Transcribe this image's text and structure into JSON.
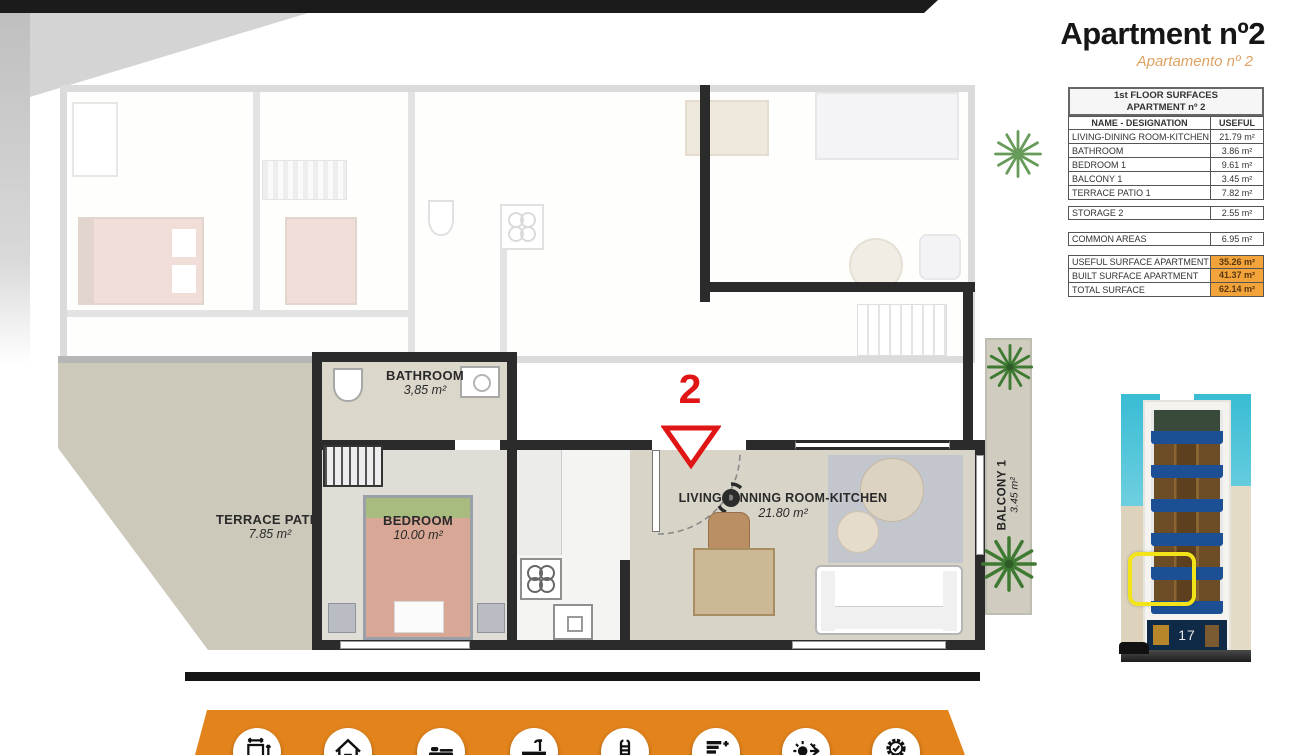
{
  "title": "Apartment nº2",
  "subtitle": "Apartamento nº 2",
  "surfaces": {
    "header": [
      "1st FLOOR SURFACES",
      "APARTMENT nº 2"
    ],
    "columns": {
      "name": "NAME - DESIGNATION",
      "useful": "USEFUL"
    },
    "rows": [
      {
        "name": "LIVING-DINING ROOM-KITCHEN",
        "value": "21.79 m²"
      },
      {
        "name": "BATHROOM",
        "value": "3.86 m²"
      },
      {
        "name": "BEDROOM 1",
        "value": "9.61 m²"
      },
      {
        "name": "BALCONY 1",
        "value": "3.45 m²"
      },
      {
        "name": "TERRACE PATIO 1",
        "value": "7.82 m²"
      }
    ],
    "storage": {
      "name": "STORAGE 2",
      "value": "2.55 m²"
    },
    "common": {
      "name": "COMMON AREAS",
      "value": "6.95 m²"
    },
    "totals": [
      {
        "name": "USEFUL SURFACE APARTMENT",
        "value": "35.26 m²"
      },
      {
        "name": "BUILT SURFACE APARTMENT",
        "value": "41.37 m²"
      },
      {
        "name": "TOTAL SURFACE",
        "value": "62.14 m²"
      }
    ]
  },
  "floorplan": {
    "unit_marker": "2",
    "rooms": {
      "bathroom": {
        "name": "BATHROOM",
        "area": "3,85 m²"
      },
      "bedroom": {
        "name": "BEDROOM",
        "area": "10.00 m²"
      },
      "living": {
        "name": "LIVING-DINNING ROOM-KITCHEN",
        "area": "21.80 m²"
      },
      "terrace": {
        "name": "TERRACE  PATIO",
        "area": "7.85 m²"
      },
      "balcony": {
        "name": "BALCONY 1",
        "area": "3.45 m²"
      }
    }
  },
  "building_thumbnail": {
    "street_number": "17"
  },
  "footer_icons": [
    "surface-dimensions",
    "house",
    "bed",
    "bathtub",
    "pool-ladder",
    "energy-rating",
    "climate-control",
    "quality-badge"
  ],
  "colors": {
    "accent_orange": "#E2831C",
    "table_highlight_orange": "#F2A43A",
    "marker_red": "#E01515",
    "highlight_yellow": "#F2E418",
    "subtitle_orange": "#DFA263"
  }
}
